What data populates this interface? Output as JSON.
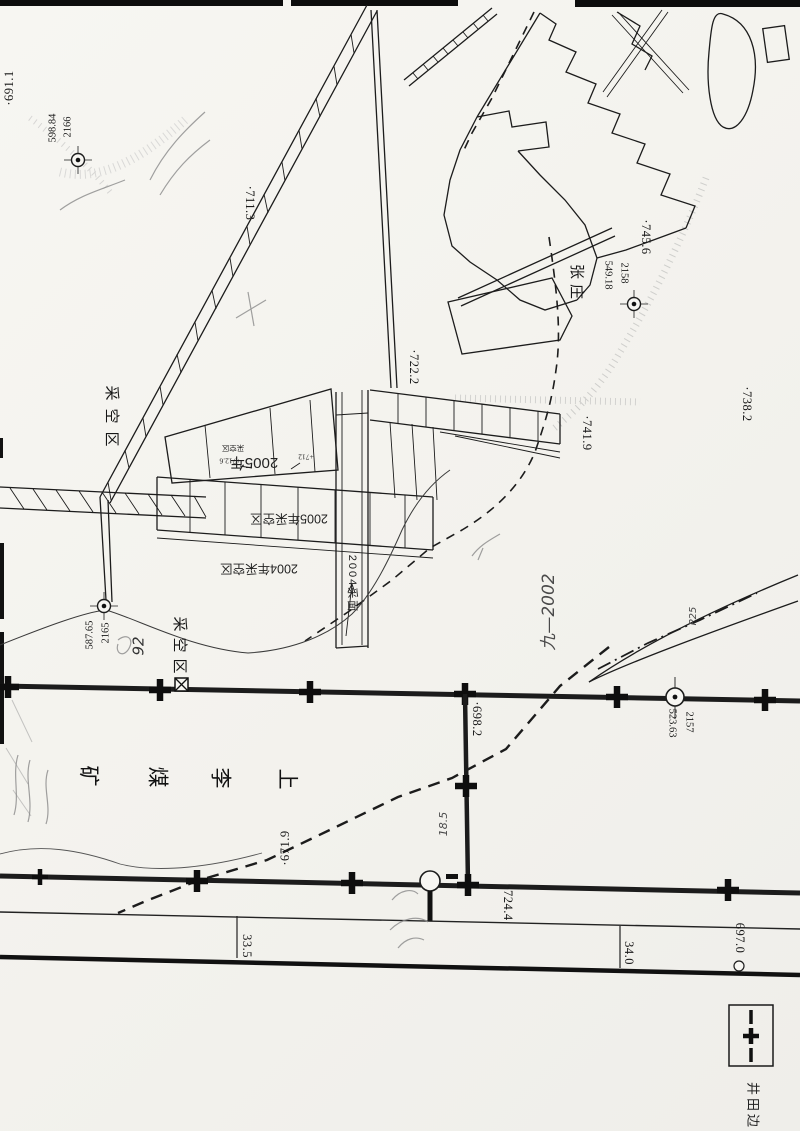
{
  "colors": {
    "ink": "#1c1c1c",
    "pencil": "#555555",
    "paper": "#f5f4f0"
  },
  "spot_heights": [
    "·691.1",
    "·711.3",
    "·722.2",
    "·741.9",
    "·738.2",
    "·745.6",
    "·698.2",
    "·671.9",
    "·724.4",
    "697.0"
  ],
  "distances": [
    "33.5",
    "34.0"
  ],
  "survey_points": [
    {
      "number": "2166",
      "elevation": "598.84"
    },
    {
      "number": "2158",
      "elevation": "549.18"
    },
    {
      "number": "2165",
      "elevation": "587.65"
    },
    {
      "number": "2157",
      "elevation": "523.63"
    }
  ],
  "place_names": {
    "village": "张庄",
    "goaf_upper": "采空区",
    "goaf_lower": "采空区",
    "mine_full": "上李煤矿",
    "mine_chars": [
      "上",
      "李",
      "煤",
      "矿"
    ]
  },
  "annotations": {
    "year_2005": "2005年",
    "goaf_small": "采空区",
    "spot_712_6": "+712.6",
    "spot_712": "+712",
    "goaf_2005": "2005年采空区",
    "goaf_2004": "2004年采空区",
    "face_2004": "2004采面",
    "pencil_period": "九—2002",
    "pencil_p25": "P25",
    "pencil_18_5": "18.5",
    "pencil_92": "92"
  },
  "legend": {
    "label": "井田边",
    "symbol": "boundary-cross"
  }
}
